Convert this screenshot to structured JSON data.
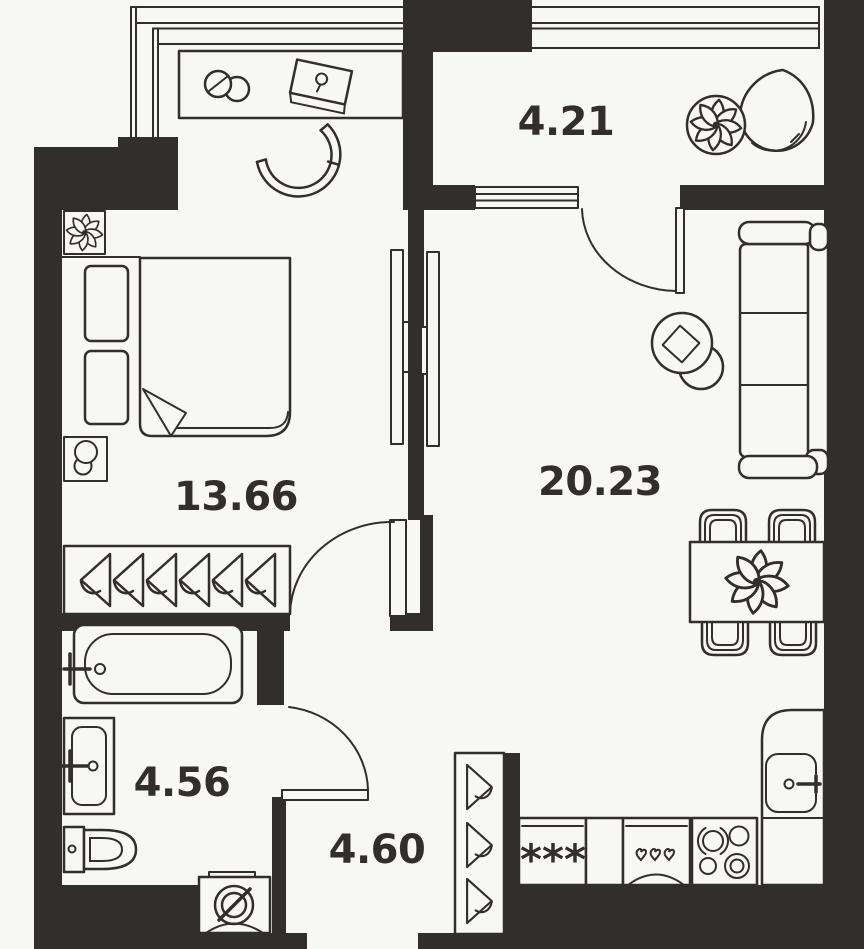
{
  "title": "apartment-floor-plan",
  "colors": {
    "background": "#f7f7f5",
    "ink": "#322e2b",
    "wall": "#322e2b"
  },
  "rooms": [
    {
      "id": "balcony",
      "area_label": "4.21",
      "furniture": [
        "potted-plant",
        "hanging-chair"
      ]
    },
    {
      "id": "bedroom",
      "area_label": "13.66",
      "furniture": [
        "double-bed",
        "nightstand",
        "nightstand",
        "bedside-lamp",
        "wardrobe-with-hangers",
        "desk",
        "desk-chair",
        "mug",
        "laptop",
        "potted-plant"
      ]
    },
    {
      "id": "living-room-kitchen",
      "area_label": "20.23",
      "furniture": [
        "sofa",
        "floor-lamp",
        "side-table",
        "dining-table",
        "dining-chairs",
        "flower-centerpiece",
        "fridge-freezer",
        "dishwasher",
        "stove",
        "kitchen-sink",
        "counter"
      ]
    },
    {
      "id": "bathroom",
      "area_label": "4.56",
      "furniture": [
        "bathtub",
        "wash-basin",
        "toilet",
        "washing-machine"
      ]
    },
    {
      "id": "hallway",
      "area_label": "4.60",
      "furniture": [
        "wardrobe-with-hangers"
      ]
    }
  ],
  "icon_texts": {
    "freezer_stars": "***"
  }
}
